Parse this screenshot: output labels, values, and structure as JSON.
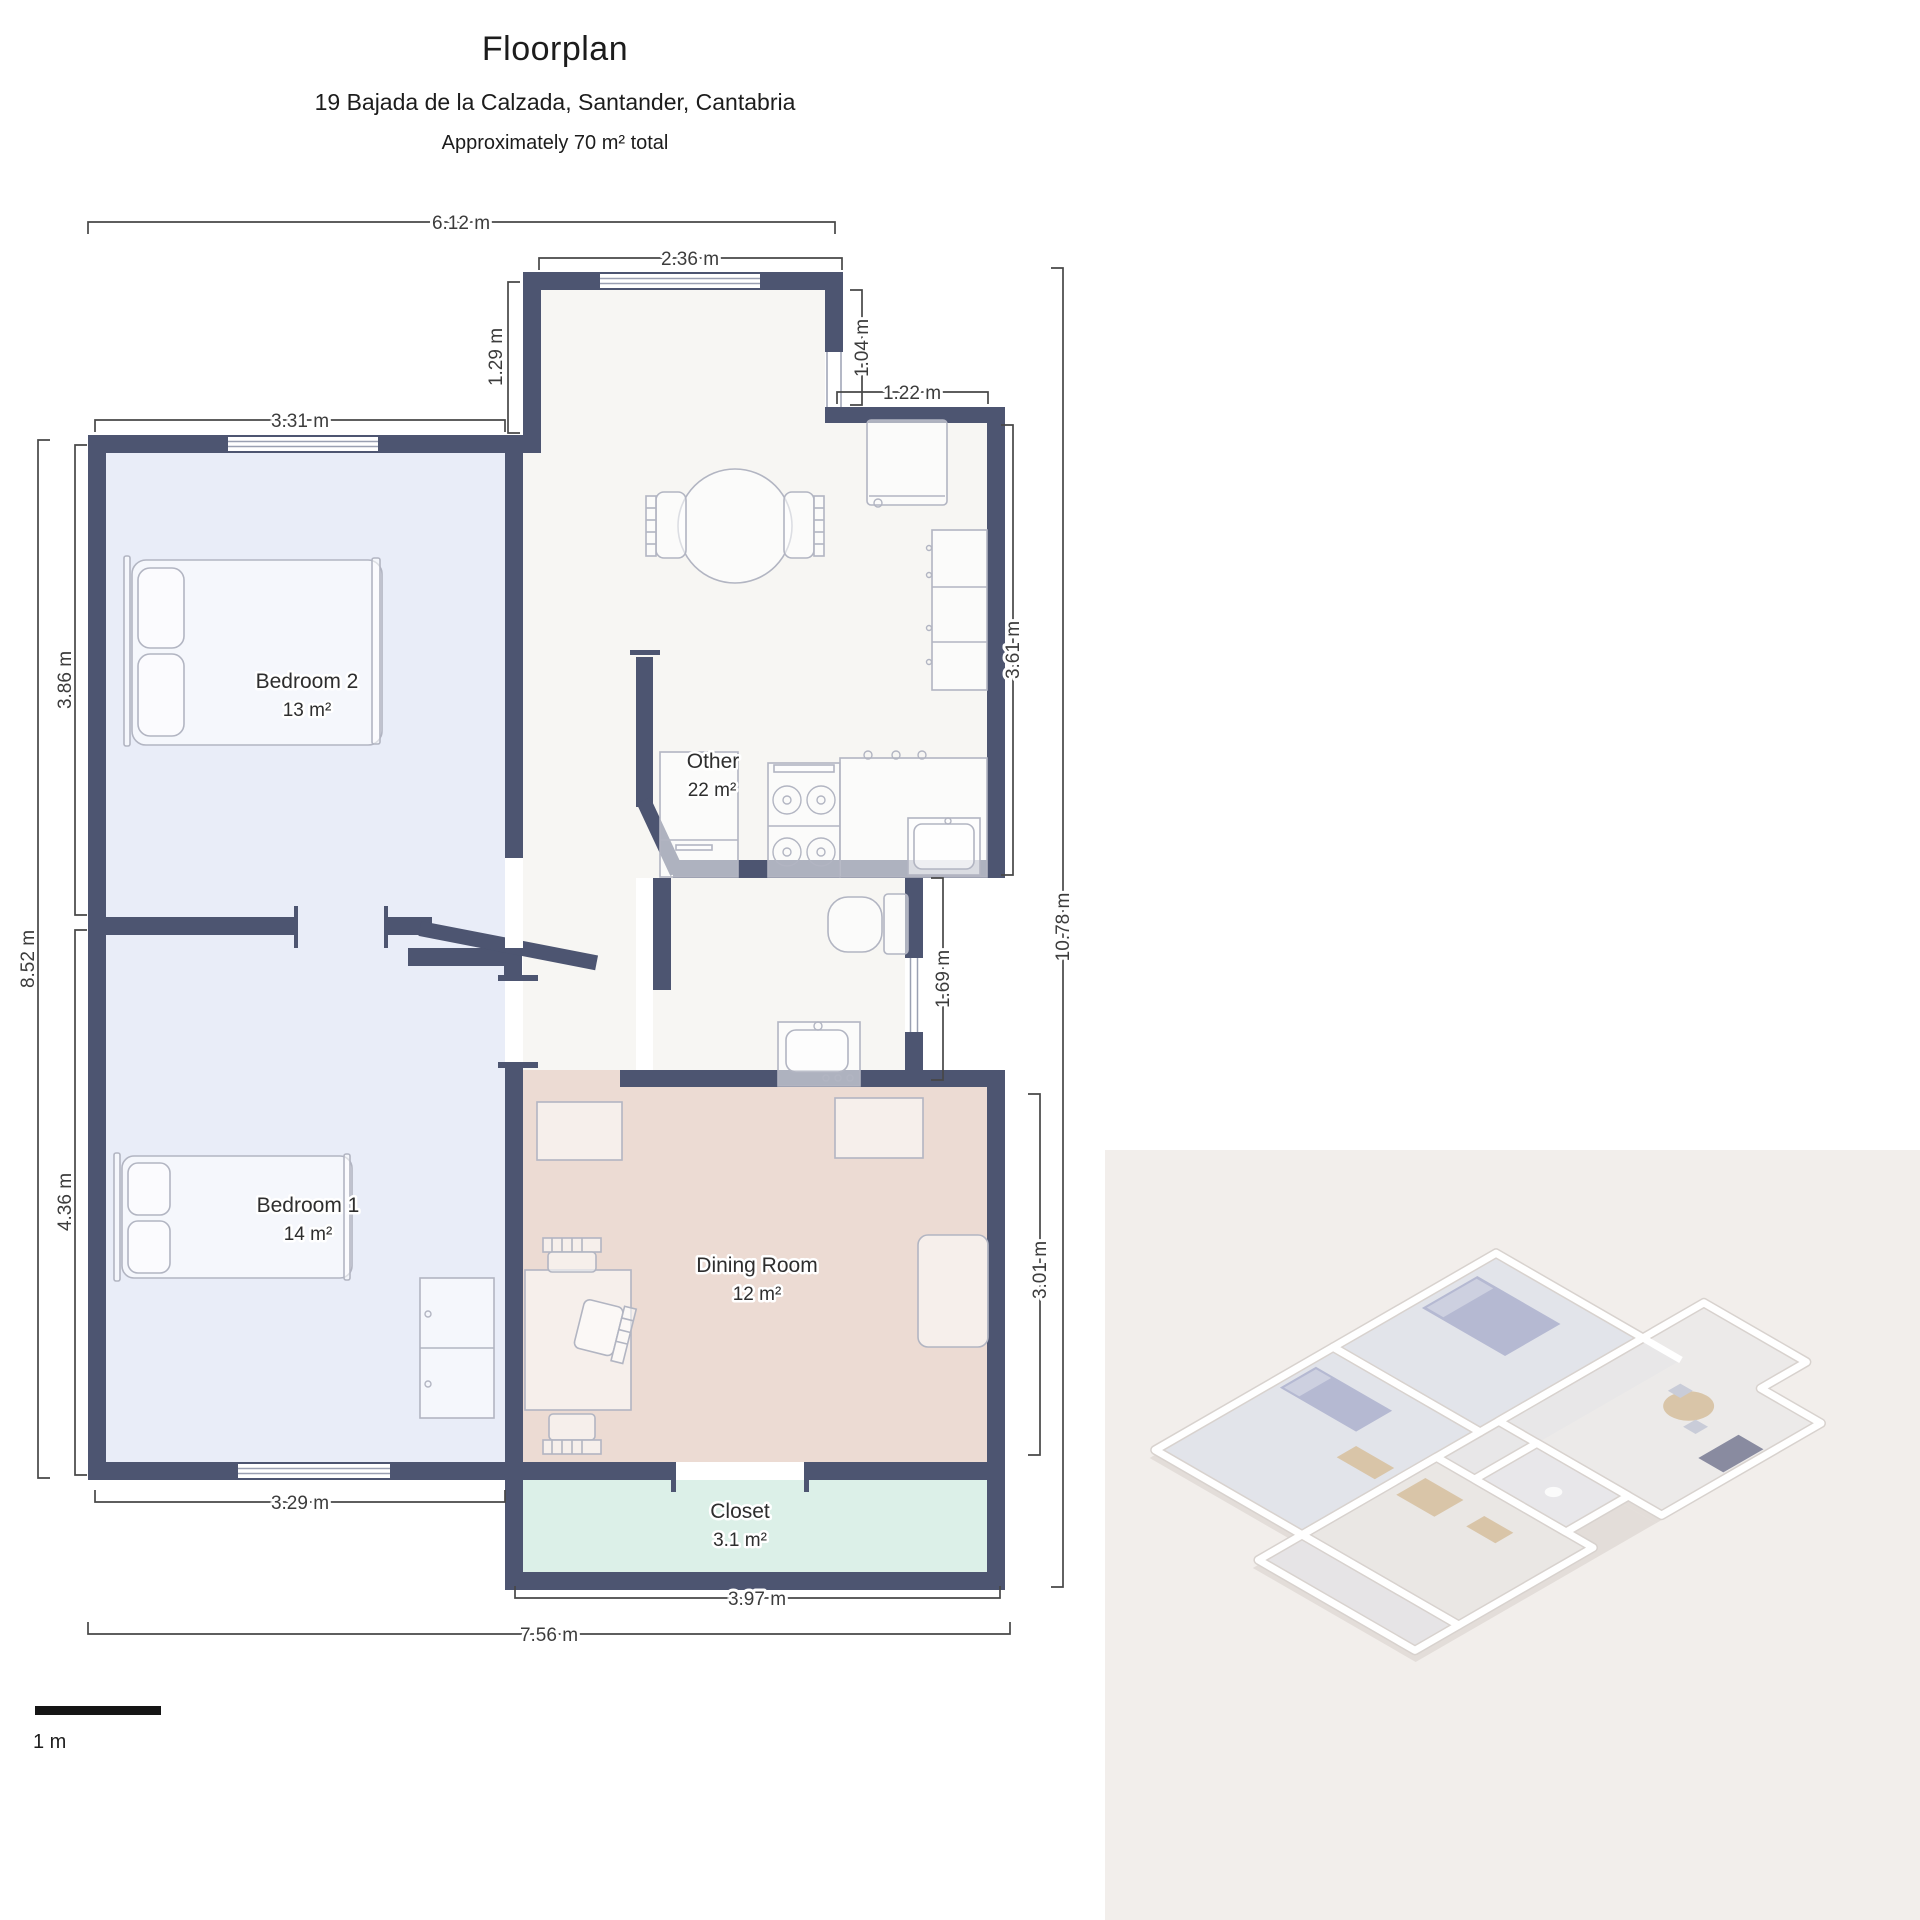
{
  "header": {
    "title": "Floorplan",
    "address": "19 Bajada de la Calzada, Santander, Cantabria",
    "area_note": "Approximately 70 m² total"
  },
  "rooms": [
    {
      "name": "Bedroom 2",
      "area": "13 m²"
    },
    {
      "name": "Bedroom 1",
      "area": "14 m²"
    },
    {
      "name": "Other",
      "area": "22 m²"
    },
    {
      "name": "Dining Room",
      "area": "12 m²"
    },
    {
      "name": "Closet",
      "area": "3.1 m²"
    }
  ],
  "dimensions": [
    "6.12 m",
    "2.36 m",
    "1.29 m",
    "1.04 m",
    "1.22 m",
    "3.31 m",
    "3.86 m",
    "8.52 m",
    "4.36 m",
    "3.61 m",
    "10.78 m",
    "1.69 m",
    "3.01 m",
    "3.29 m",
    "3.97 m",
    "7.56 m"
  ],
  "scale_bar": {
    "label": "1 m"
  },
  "colors": {
    "wall": "#4d5571",
    "bedroom_fill": "#e9edf8",
    "kitchen_fill": "#f7f6f3",
    "dining_fill": "#ecdbd3",
    "closet_fill": "#dcf0e8",
    "panel_bg": "#f2eeeb"
  }
}
